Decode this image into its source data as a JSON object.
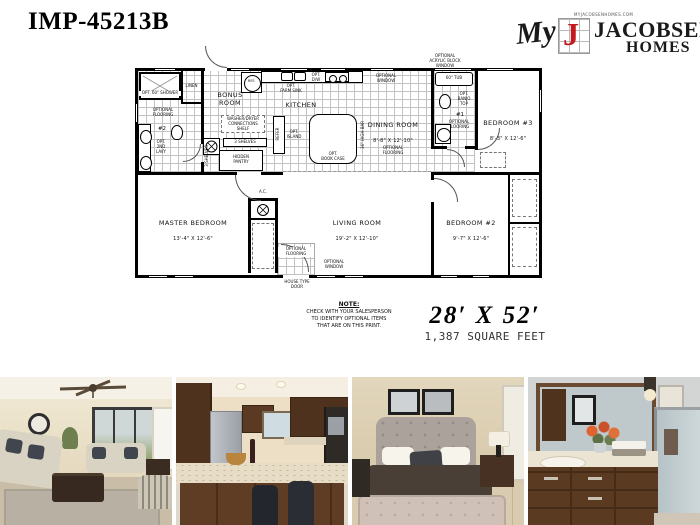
{
  "header": {
    "model": "IMP-45213B",
    "logo": {
      "script": "My",
      "letter": "J",
      "name1": "JACOBSEN",
      "name2": "HOMES",
      "tagline": "MYJACOBSENHOMES.COM"
    }
  },
  "plan": {
    "labels": {
      "opt_shower": "OPT. 60\" SHOWER",
      "linen": "LINEN",
      "optional_flooring": "OPTIONAL\nFLOORING",
      "bath2_num": "#2",
      "opt_2nd_lavy": "OPT.\n2ND\nLAVY",
      "washer_dryer": "WASHER/DRYER\nCONNECTIONS\nSHELF",
      "shelves": "3 SHELVES",
      "hidden_pantry": "HIDDEN\nPANTRY",
      "refer": "REFER",
      "ref": "REF.",
      "opt_farm_sink": "OPT.\nFARM SINK",
      "opt_dw": "OPT.\nD/W",
      "opt_island": "OPT.\nISLAND",
      "opt_book_case": "OPT.\nBOOK CASE",
      "high_bar": "36\" HIGH BAR",
      "optional_window": "OPTIONAL\nWINDOW",
      "acrylic_window": "OPTIONAL\nACRYLIC BLOCK\nWINDOW",
      "tub": "60\" TUB",
      "opt_banjo_top": "OPT.\nBANJO\nTOP",
      "bath1_num": "#1",
      "ac": "A.C.",
      "house_type_door": "HOUSE TYPE\nDOOR"
    },
    "rooms": {
      "bonus": {
        "name": "BONUS\nROOM"
      },
      "kitchen": {
        "name": "KITCHEN"
      },
      "dining": {
        "name": "DINING ROOM",
        "dims": "8'-8\" X 12'-10\""
      },
      "bedroom3": {
        "name": "BEDROOM #3",
        "dims": "8'-3\" X 12'-6\""
      },
      "master": {
        "name": "MASTER BEDROOM",
        "dims": "13'-4\" X 12'-6\""
      },
      "living": {
        "name": "LIVING ROOM",
        "dims": "19'-2\" X 12'-10\""
      },
      "bedroom2": {
        "name": "BEDROOM #2",
        "dims": "9'-7\" X 12'-6\""
      }
    }
  },
  "note": {
    "title": "NOTE:",
    "body": "CHECK WITH YOUR SALESPERSON\nTO IDENTIFY OPTIONAL ITEMS\nTHAT ARE ON THIS PRINT."
  },
  "size": {
    "dims": "28′ X 52′",
    "sqft": "1,387 SQUARE FEET"
  },
  "photos": [
    {
      "subject": "living room"
    },
    {
      "subject": "kitchen"
    },
    {
      "subject": "bedroom"
    },
    {
      "subject": "bathroom"
    }
  ],
  "colors": {
    "logo_red": "#c41a1f",
    "line": "#000000"
  }
}
